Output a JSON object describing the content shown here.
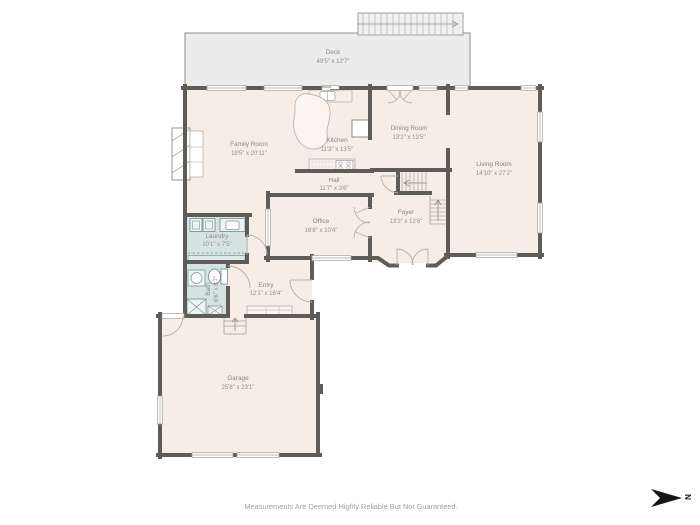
{
  "page": {
    "disclaimer": "Measurements Are Deemed Highly Reliable But Not Guaranteed.",
    "compass": {
      "label": "N",
      "points": "right"
    }
  },
  "floor_plan": {
    "colors": {
      "wall": "#5e5c59",
      "room_fill": "#f6ede7",
      "wet_room_fill": "#d5e4e3",
      "deck_fill": "#ececec",
      "label_text": "#8c8780"
    },
    "rooms": [
      {
        "name": "Deck",
        "dims": "49'5\" x 12'7\""
      },
      {
        "name": "Family Room",
        "dims": "19'5\" x 20'11\""
      },
      {
        "name": "Kitchen",
        "dims": "11'3\" x 13'5\""
      },
      {
        "name": "Dining Room",
        "dims": "13'2\" x 13'5\""
      },
      {
        "name": "Living Room",
        "dims": "14'10\" x 27'2\""
      },
      {
        "name": "Hall",
        "dims": "11'7\" x 3'6\""
      },
      {
        "name": "Office",
        "dims": "16'8\" x 10'4\""
      },
      {
        "name": "Foyer",
        "dims": "13'2\" x 12'6\""
      },
      {
        "name": "Laundry",
        "dims": "10'1\" x 7'5\""
      },
      {
        "name": "Bath",
        "dims": "6'6\" x 8'7\""
      },
      {
        "name": "Entry",
        "dims": "12'1\" x 16'4\""
      },
      {
        "name": "Garage",
        "dims": "25'8\" x 23'1\""
      }
    ]
  }
}
